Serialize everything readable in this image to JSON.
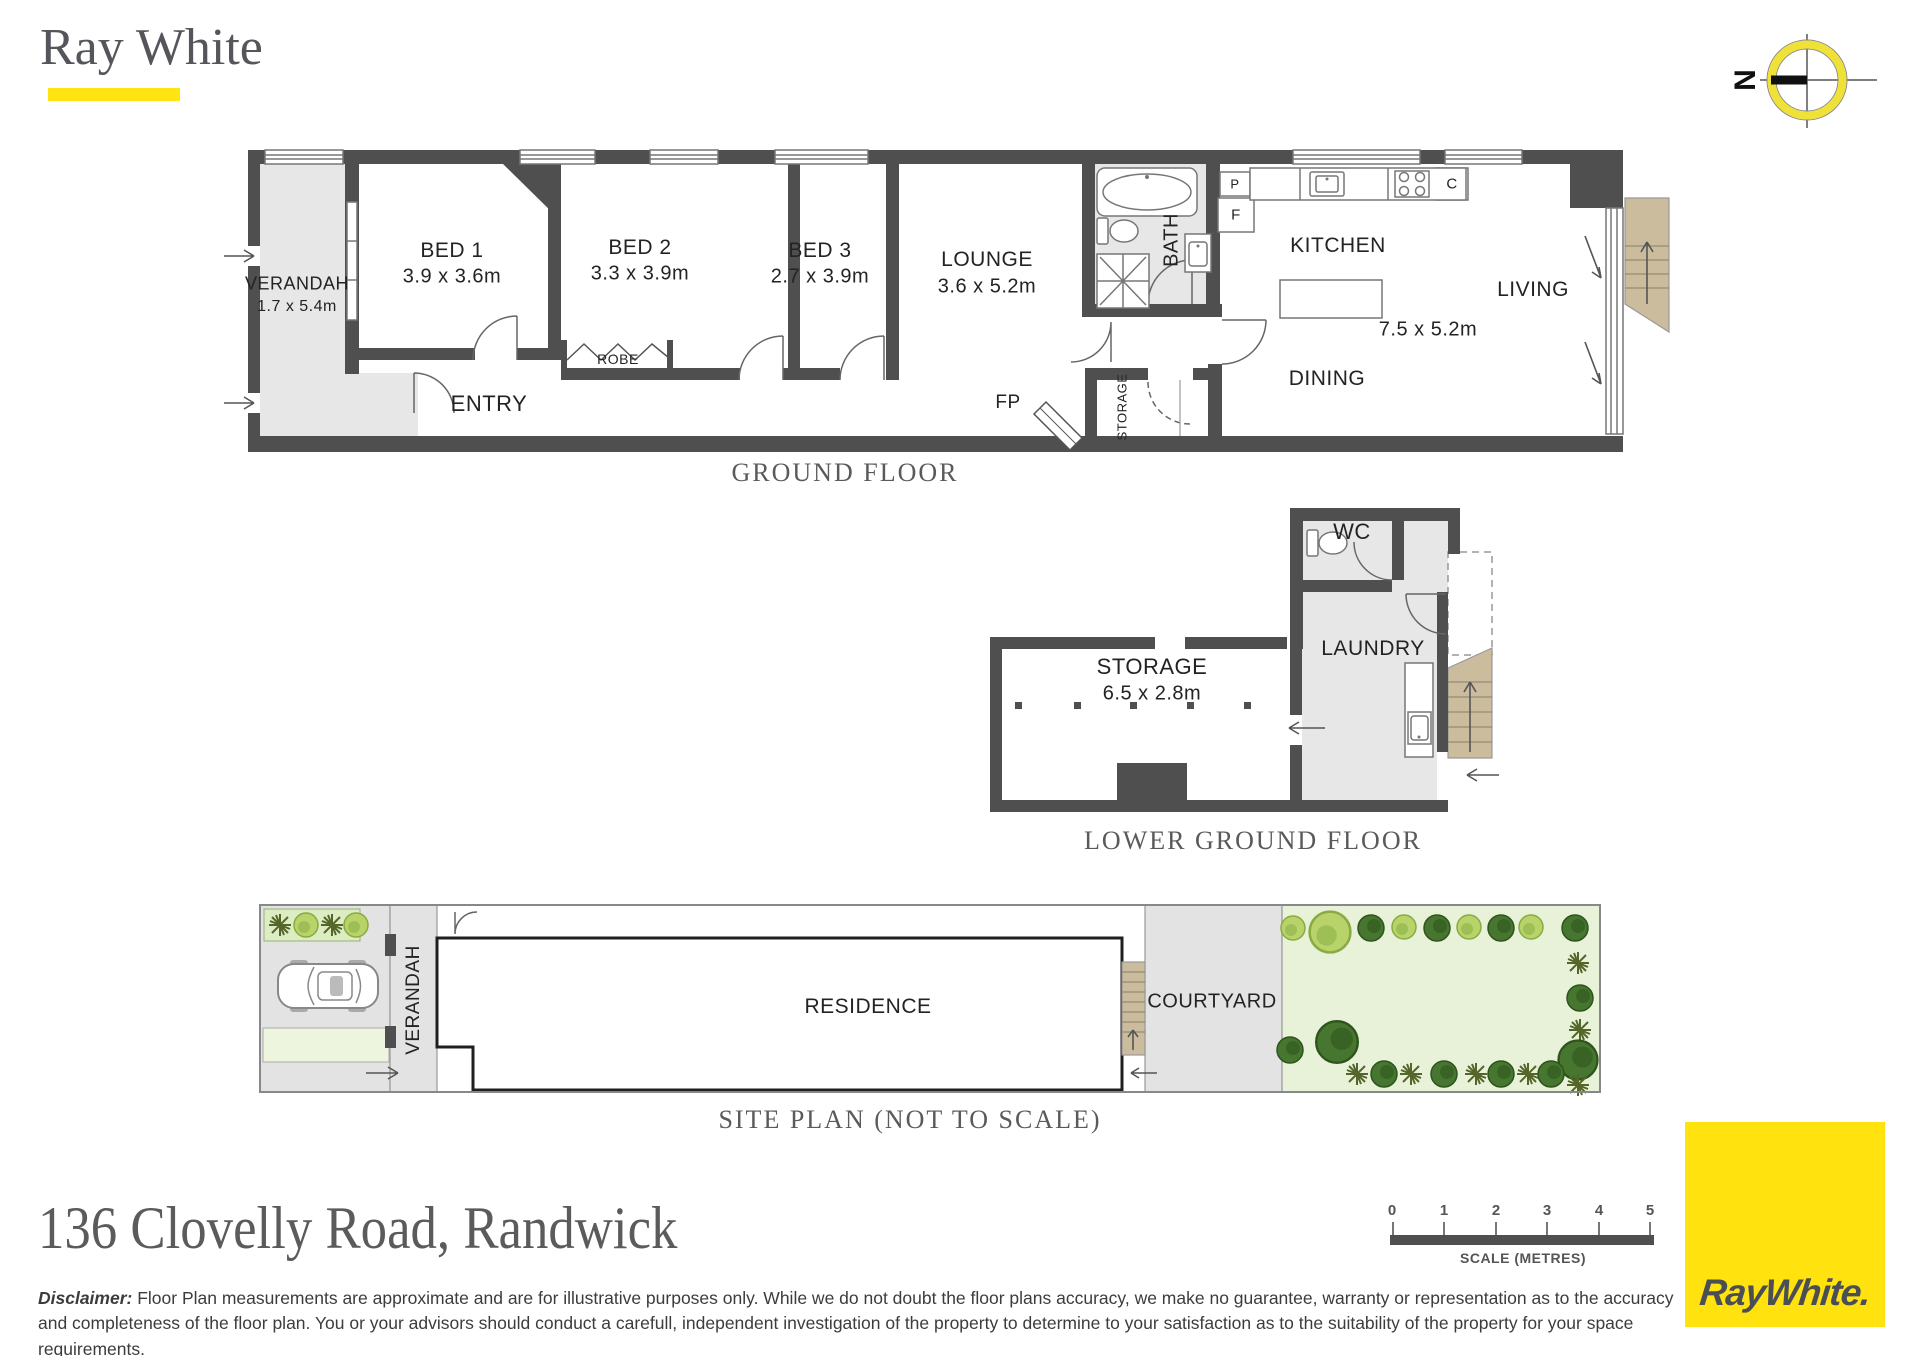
{
  "brand": {
    "name": "Ray White",
    "logo_text": "RayWhite.",
    "accent_yellow": "#ffe412"
  },
  "compass": {
    "north": "N"
  },
  "ground_floor": {
    "title": "GROUND FLOOR",
    "rooms": {
      "verandah": {
        "name": "VERANDAH",
        "dims": "1.7 x 5.4m"
      },
      "bed1": {
        "name": "BED 1",
        "dims": "3.9 x 3.6m"
      },
      "bed2": {
        "name": "BED 2",
        "dims": "3.3 x 3.9m"
      },
      "bed3": {
        "name": "BED 3",
        "dims": "2.7 x 3.9m"
      },
      "lounge": {
        "name": "LOUNGE",
        "dims": "3.6 x 5.2m"
      },
      "living_area": {
        "kitchen": "KITCHEN",
        "living": "LIVING",
        "dining": "DINING",
        "dims": "7.5 x 5.2m"
      },
      "entry": "ENTRY",
      "robe": "ROBE",
      "bath": "BATH",
      "storage": "STORAGE",
      "fireplace": "FP",
      "pantry": "P",
      "fridge": "F",
      "cooker": "C"
    }
  },
  "lower_ground_floor": {
    "title": "LOWER GROUND FLOOR",
    "rooms": {
      "wc": "WC",
      "laundry": "LAUNDRY",
      "storage": {
        "name": "STORAGE",
        "dims": "6.5 x 2.8m"
      }
    }
  },
  "site_plan": {
    "title": "SITE PLAN (NOT TO SCALE)",
    "labels": {
      "verandah": "VERANDAH",
      "residence": "RESIDENCE",
      "courtyard": "COURTYARD"
    }
  },
  "address": "136 Clovelly Road, Randwick",
  "disclaimer": {
    "label": "Disclaimer:",
    "text": " Floor Plan measurements are approximate and are for illustrative purposes only. While we do not doubt the  floor  plans  accuracy,  we make no guarantee, warranty or representation as to the accuracy and completeness of the floor plan.  You  or  your  advisors  should  conduct a carefull, independent investigation of the property to determine to your satisfaction as to the suitability of the property for your space requirements."
  },
  "scale_bar": {
    "ticks": [
      "0",
      "1",
      "2",
      "3",
      "4",
      "5"
    ],
    "label": "SCALE (METRES)"
  }
}
